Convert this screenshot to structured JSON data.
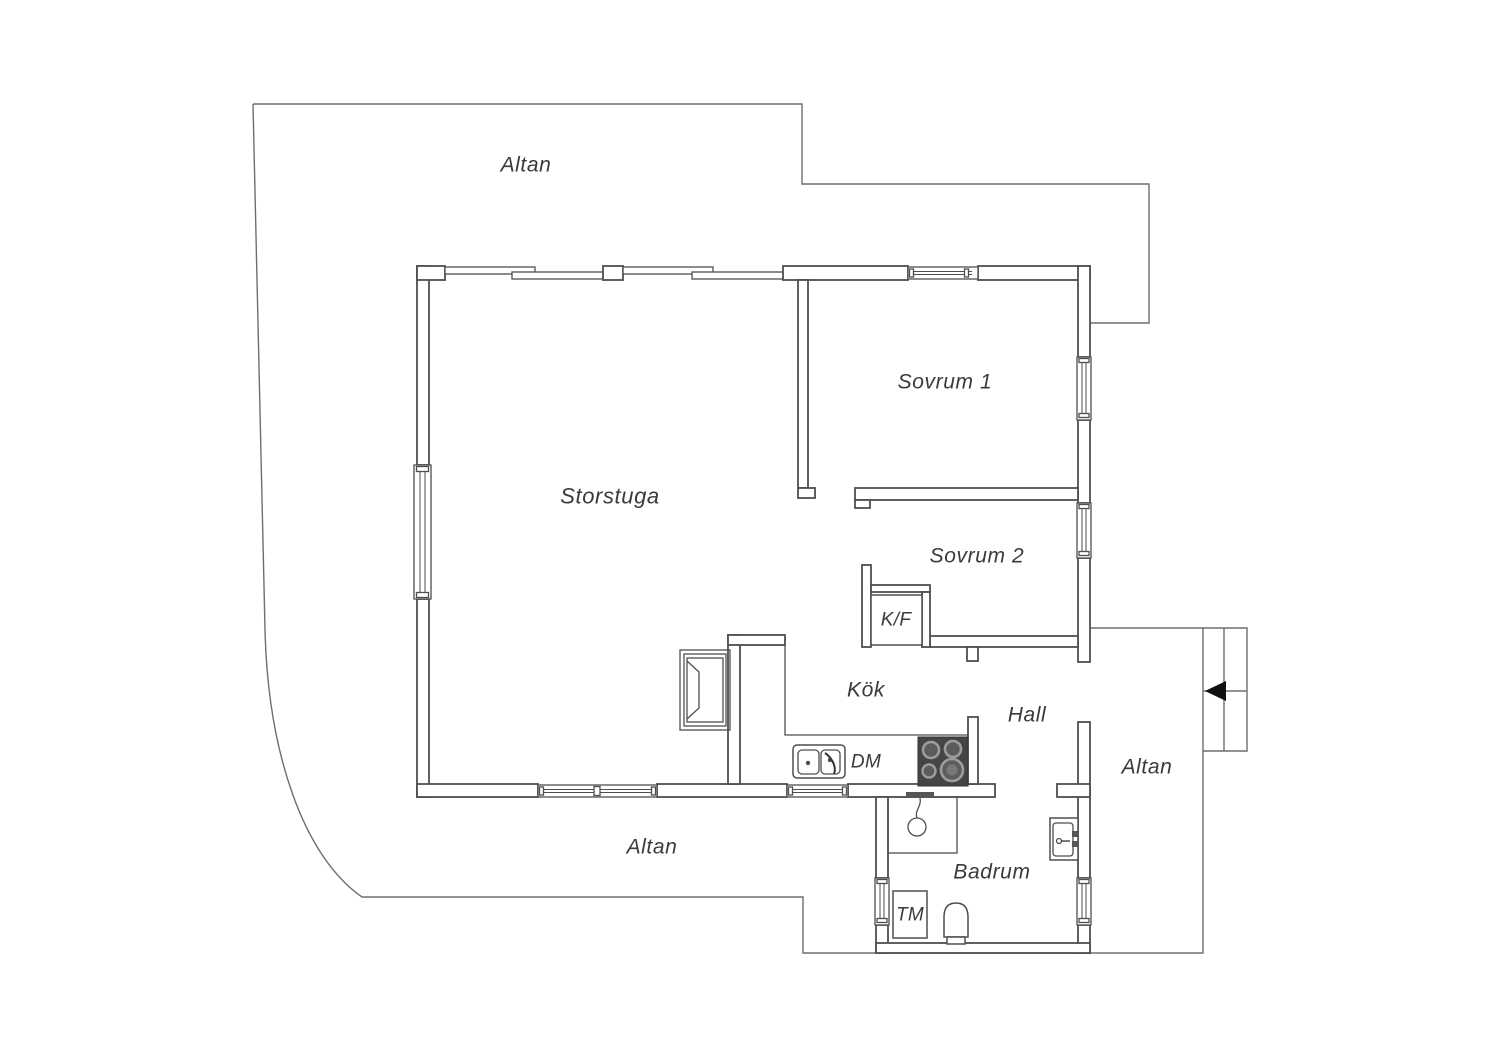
{
  "colors": {
    "wall-stroke": "#4f4f4f",
    "thin-line": "#6e6e6e",
    "label-text": "#3a3a3a",
    "stove-body": "#454545",
    "burner-ring": "#9c9c9c",
    "burner-center": "#5c5c5c",
    "arrow-fill": "#111111",
    "bg": "#ffffff"
  },
  "rooms": {
    "terrace_top": {
      "label": "Altan"
    },
    "living_room": {
      "label": "Storstuga"
    },
    "bedroom_1": {
      "label": "Sovrum 1"
    },
    "bedroom_2": {
      "label": "Sovrum 2"
    },
    "kitchen": {
      "label": "Kök"
    },
    "hall": {
      "label": "Hall"
    },
    "bathroom": {
      "label": "Badrum"
    },
    "terrace_right": {
      "label": "Altan"
    },
    "terrace_bottom": {
      "label": "Altan"
    }
  },
  "appliances": {
    "fridge_freezer": {
      "label": "K/F"
    },
    "dishwasher": {
      "label": "DM"
    },
    "washing_machine": {
      "label": "TM"
    }
  }
}
